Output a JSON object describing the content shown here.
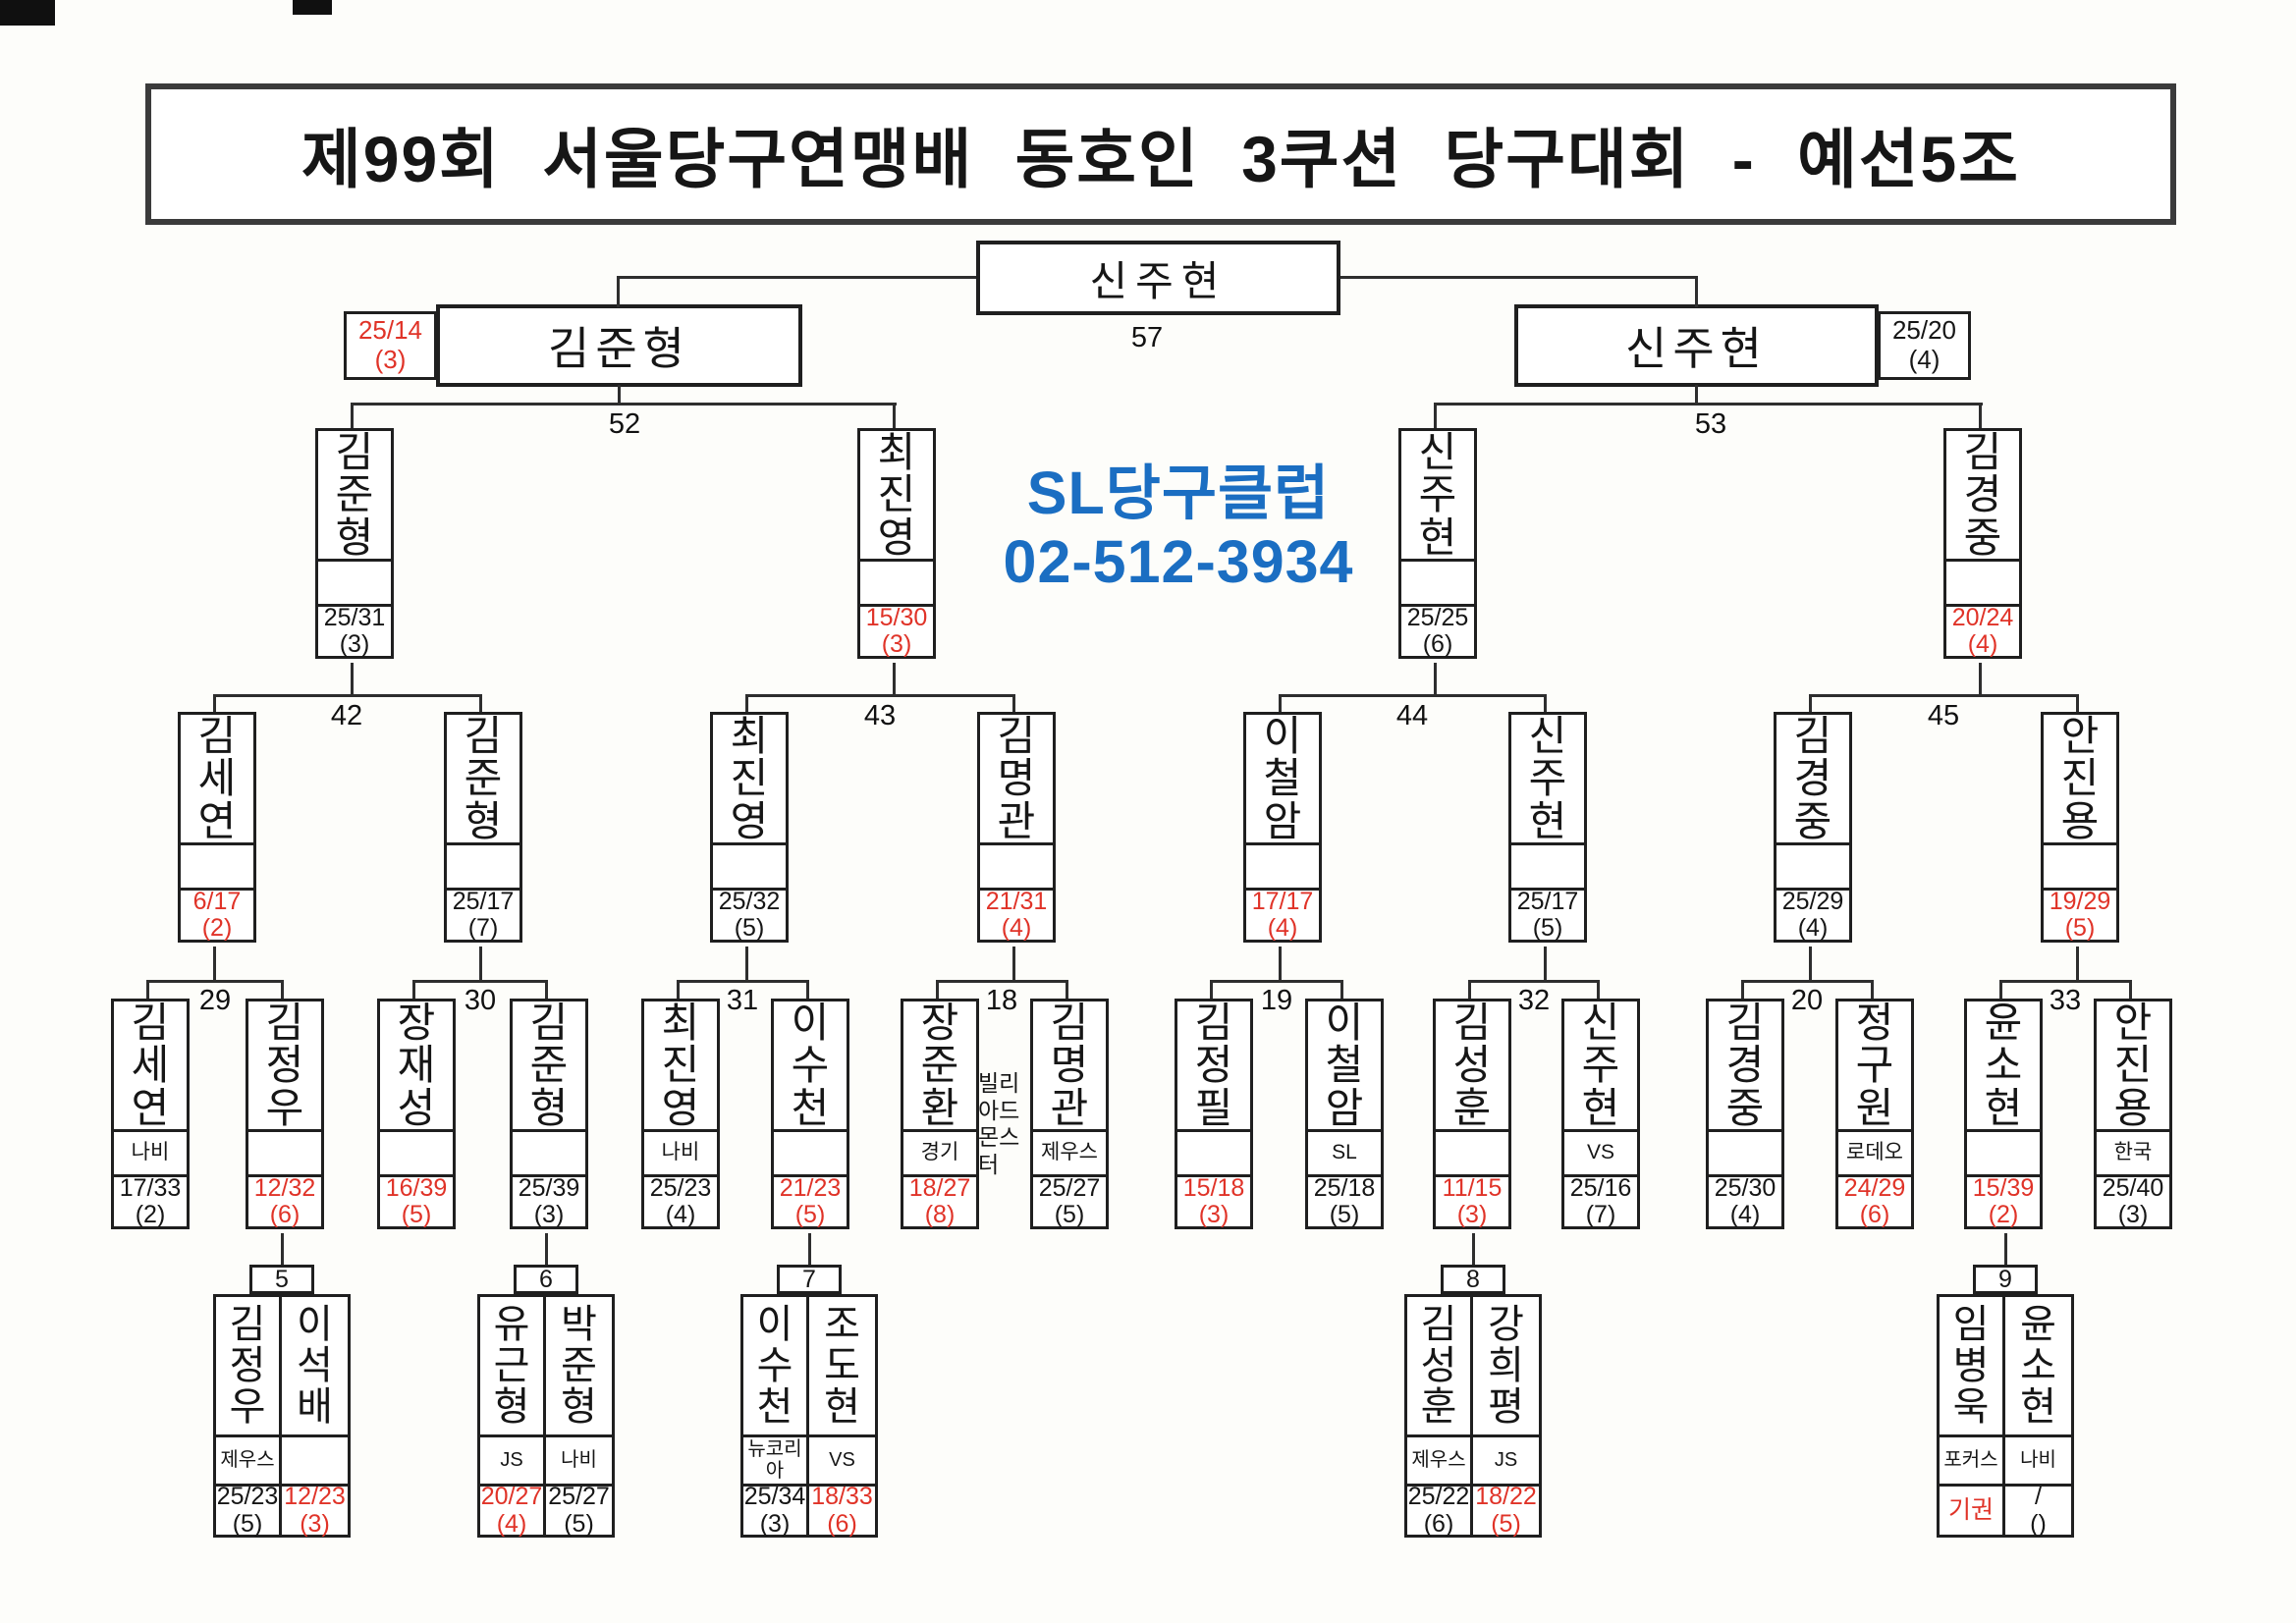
{
  "title": "제99회 서울당구연맹배 동호인 3쿠션 당구대회 - 예선5조",
  "sponsor": {
    "line1": "SL당구클럽",
    "line2": "02-512-3934",
    "color": "#1b6ec2"
  },
  "colors": {
    "loser_score_red": "#e03328",
    "winner_score_black": "#161616",
    "line": "#2e2e2e"
  },
  "final": {
    "match_no": "57",
    "champion": {
      "name": "신주현"
    },
    "left": {
      "name": "김준형",
      "score": "25/14",
      "innings": "(3)",
      "result": "lose"
    },
    "right": {
      "name": "신주현",
      "score": "25/20",
      "innings": "(4)",
      "result": "win"
    }
  },
  "semifinals": [
    {
      "match_no": "52",
      "players": [
        {
          "name": "김준형",
          "club": "",
          "score": "25/31",
          "innings": "(3)",
          "result": "win"
        },
        {
          "name": "최진영",
          "club": "",
          "score": "15/30",
          "innings": "(3)",
          "result": "lose"
        }
      ]
    },
    {
      "match_no": "53",
      "players": [
        {
          "name": "신주현",
          "club": "",
          "score": "25/25",
          "innings": "(6)",
          "result": "win"
        },
        {
          "name": "김경중",
          "club": "",
          "score": "20/24",
          "innings": "(4)",
          "result": "lose"
        }
      ]
    }
  ],
  "quarterfinals": [
    {
      "match_no": "42",
      "players": [
        {
          "name": "김세연",
          "club": "",
          "score": "6/17",
          "innings": "(2)",
          "result": "lose"
        },
        {
          "name": "김준형",
          "club": "",
          "score": "25/17",
          "innings": "(7)",
          "result": "win"
        }
      ]
    },
    {
      "match_no": "43",
      "players": [
        {
          "name": "최진영",
          "club": "",
          "score": "25/32",
          "innings": "(5)",
          "result": "win"
        },
        {
          "name": "김명관",
          "club": "",
          "score": "21/31",
          "innings": "(4)",
          "result": "lose"
        }
      ]
    },
    {
      "match_no": "44",
      "players": [
        {
          "name": "이철암",
          "club": "",
          "score": "17/17",
          "innings": "(4)",
          "result": "lose"
        },
        {
          "name": "신주현",
          "club": "",
          "score": "25/17",
          "innings": "(5)",
          "result": "win"
        }
      ]
    },
    {
      "match_no": "45",
      "players": [
        {
          "name": "김경중",
          "club": "",
          "score": "25/29",
          "innings": "(4)",
          "result": "win"
        },
        {
          "name": "안진용",
          "club": "",
          "score": "19/29",
          "innings": "(5)",
          "result": "lose"
        }
      ]
    }
  ],
  "round_of_16": [
    {
      "match_no": "29",
      "players": [
        {
          "name": "김세연",
          "club": "나비",
          "score": "17/33",
          "innings": "(2)",
          "result": "win"
        },
        {
          "name": "김정우",
          "club": "",
          "score": "12/32",
          "innings": "(6)",
          "result": "lose"
        }
      ]
    },
    {
      "match_no": "30",
      "players": [
        {
          "name": "장재성",
          "club": "",
          "score": "16/39",
          "innings": "(5)",
          "result": "lose"
        },
        {
          "name": "김준형",
          "club": "",
          "score": "25/39",
          "innings": "(3)",
          "result": "win"
        }
      ]
    },
    {
      "match_no": "31",
      "players": [
        {
          "name": "최진영",
          "club": "나비",
          "score": "25/23",
          "innings": "(4)",
          "result": "win"
        },
        {
          "name": "이수천",
          "club": "",
          "score": "21/23",
          "innings": "(5)",
          "result": "lose"
        }
      ]
    },
    {
      "match_no": "18",
      "players": [
        {
          "name": "장준환",
          "club": "경기",
          "club_note": "빌리아드몬스터",
          "score": "18/27",
          "innings": "(8)",
          "result": "lose"
        },
        {
          "name": "김명관",
          "club": "제우스",
          "score": "25/27",
          "innings": "(5)",
          "result": "win"
        }
      ]
    },
    {
      "match_no": "19",
      "players": [
        {
          "name": "김정필",
          "club": "",
          "score": "15/18",
          "innings": "(3)",
          "result": "lose"
        },
        {
          "name": "이철암",
          "club": "SL",
          "score": "25/18",
          "innings": "(5)",
          "result": "win"
        }
      ]
    },
    {
      "match_no": "32",
      "players": [
        {
          "name": "김성훈",
          "club": "",
          "score": "11/15",
          "innings": "(3)",
          "result": "lose"
        },
        {
          "name": "신주현",
          "club": "VS",
          "score": "25/16",
          "innings": "(7)",
          "result": "win"
        }
      ]
    },
    {
      "match_no": "20",
      "players": [
        {
          "name": "김경중",
          "club": "",
          "score": "25/30",
          "innings": "(4)",
          "result": "win"
        },
        {
          "name": "정구원",
          "club": "로데오",
          "score": "24/29",
          "innings": "(6)",
          "result": "lose"
        }
      ]
    },
    {
      "match_no": "33",
      "players": [
        {
          "name": "윤소현",
          "club": "",
          "score": "15/39",
          "innings": "(2)",
          "result": "lose"
        },
        {
          "name": "안진용",
          "club": "한국",
          "score": "25/40",
          "innings": "(3)",
          "result": "win"
        }
      ]
    }
  ],
  "round_1": [
    {
      "match_no": "5",
      "players": [
        {
          "name": "김정우",
          "club": "제우스",
          "score": "25/23",
          "innings": "(5)",
          "result": "win"
        },
        {
          "name": "이석배",
          "club": "",
          "score": "12/23",
          "innings": "(3)",
          "result": "lose"
        }
      ]
    },
    {
      "match_no": "6",
      "players": [
        {
          "name": "유근형",
          "club": "JS",
          "score": "20/27",
          "innings": "(4)",
          "result": "lose"
        },
        {
          "name": "박준형",
          "club": "나비",
          "score": "25/27",
          "innings": "(5)",
          "result": "win"
        }
      ]
    },
    {
      "match_no": "7",
      "players": [
        {
          "name": "이수천",
          "club": "뉴코리아",
          "score": "25/34",
          "innings": "(3)",
          "result": "win"
        },
        {
          "name": "조도현",
          "club": "VS",
          "score": "18/33",
          "innings": "(6)",
          "result": "lose"
        }
      ]
    },
    {
      "match_no": "8",
      "players": [
        {
          "name": "김성훈",
          "club": "제우스",
          "score": "25/22",
          "innings": "(6)",
          "result": "win"
        },
        {
          "name": "강희평",
          "club": "JS",
          "score": "18/22",
          "innings": "(5)",
          "result": "lose"
        }
      ]
    },
    {
      "match_no": "9",
      "players": [
        {
          "name": "임병욱",
          "club": "포커스",
          "score": "기권",
          "innings": "",
          "result": "lose"
        },
        {
          "name": "윤소현",
          "club": "나비",
          "score": "/",
          "innings": "()",
          "result": "win"
        }
      ]
    }
  ]
}
